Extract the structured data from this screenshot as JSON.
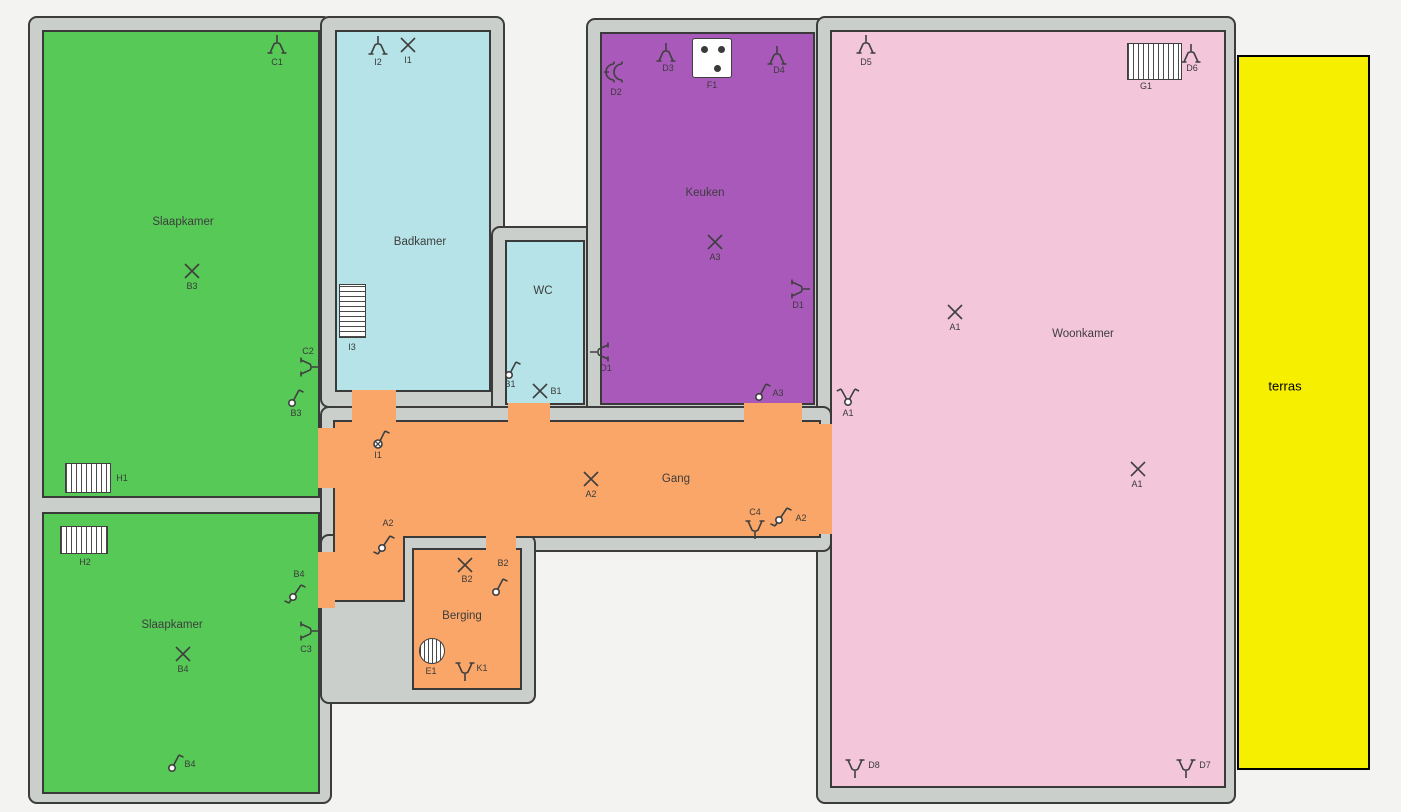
{
  "title": "Plattegrond elektrische installatie",
  "colors": {
    "wall": "#cbcfcb",
    "wall_edge": "#3c3c3c",
    "green": "#57c957",
    "cyan": "#b5e3e7",
    "purple": "#a959ba",
    "pink": "#f4c6da",
    "orange": "#f9a668",
    "yellow": "#f7ef00",
    "stroke": "#3f3f3f",
    "label": "#3d3d3d",
    "terras_border": "#000000"
  },
  "walls": [
    {
      "x": 28,
      "y": 16,
      "w": 304,
      "h": 788
    },
    {
      "x": 320,
      "y": 16,
      "w": 185,
      "h": 392
    },
    {
      "x": 491,
      "y": 226,
      "w": 108,
      "h": 192
    },
    {
      "x": 586,
      "y": 18,
      "w": 243,
      "h": 400
    },
    {
      "x": 816,
      "y": 16,
      "w": 420,
      "h": 788
    },
    {
      "x": 320,
      "y": 406,
      "w": 512,
      "h": 146
    },
    {
      "x": 320,
      "y": 534,
      "w": 216,
      "h": 170
    }
  ],
  "rooms": [
    {
      "id": "slaapkamer-1",
      "label": "Slaapkamer",
      "x": 42,
      "y": 30,
      "w": 278,
      "h": 468,
      "color": "green",
      "lx": 183,
      "ly": 222
    },
    {
      "id": "slaapkamer-2",
      "label": "Slaapkamer",
      "x": 42,
      "y": 512,
      "w": 278,
      "h": 282,
      "color": "green",
      "lx": 172,
      "ly": 625
    },
    {
      "id": "badkamer",
      "label": "Badkamer",
      "x": 335,
      "y": 30,
      "w": 156,
      "h": 362,
      "color": "cyan",
      "lx": 420,
      "ly": 242
    },
    {
      "id": "wc",
      "label": "WC",
      "x": 505,
      "y": 240,
      "w": 80,
      "h": 165,
      "color": "cyan",
      "lx": 543,
      "ly": 291
    },
    {
      "id": "keuken",
      "label": "Keuken",
      "x": 600,
      "y": 32,
      "w": 215,
      "h": 373,
      "color": "purple",
      "lx": 705,
      "ly": 193
    },
    {
      "id": "woonkamer",
      "label": "Woonkamer",
      "x": 830,
      "y": 30,
      "w": 396,
      "h": 758,
      "color": "pink",
      "lx": 1083,
      "ly": 334
    },
    {
      "id": "gang-vertikaal",
      "label": "",
      "x": 333,
      "y": 420,
      "w": 72,
      "h": 182,
      "color": "orange",
      "lx": 0,
      "ly": 0
    },
    {
      "id": "gang",
      "label": "Gang",
      "x": 333,
      "y": 420,
      "w": 488,
      "h": 118,
      "color": "orange",
      "lx": 676,
      "ly": 479
    },
    {
      "id": "berging",
      "label": "Berging",
      "x": 412,
      "y": 548,
      "w": 110,
      "h": 142,
      "color": "orange",
      "lx": 462,
      "ly": 616
    },
    {
      "id": "terras",
      "label": "terras",
      "x": 1237,
      "y": 55,
      "w": 133,
      "h": 715,
      "color": "yellow",
      "lx": 1285,
      "ly": 386,
      "border": "terras_border",
      "labelSize": 13
    }
  ],
  "gaps": [
    {
      "x": 335,
      "y": 422,
      "w": 68,
      "h": 118,
      "color": "orange"
    },
    {
      "x": 818,
      "y": 424,
      "w": 14,
      "h": 110,
      "color": "orange"
    },
    {
      "x": 352,
      "y": 390,
      "w": 44,
      "h": 32,
      "color": "orange"
    },
    {
      "x": 508,
      "y": 403,
      "w": 42,
      "h": 19,
      "color": "orange"
    },
    {
      "x": 744,
      "y": 403,
      "w": 58,
      "h": 19,
      "color": "orange"
    },
    {
      "x": 318,
      "y": 428,
      "w": 17,
      "h": 60,
      "color": "orange"
    },
    {
      "x": 318,
      "y": 552,
      "w": 17,
      "h": 56,
      "color": "orange"
    },
    {
      "x": 486,
      "y": 536,
      "w": 30,
      "h": 14,
      "color": "orange"
    }
  ],
  "symbols": [
    {
      "type": "wall-lamp",
      "x": 277,
      "y": 47,
      "rot": 0,
      "label": "C1",
      "lx": 277,
      "ly": 62
    },
    {
      "type": "ceiling-light",
      "x": 192,
      "y": 271,
      "label": "B3",
      "lx": 192,
      "ly": 286
    },
    {
      "type": "wall-lamp",
      "x": 307,
      "y": 367,
      "rot": 90,
      "label": "C2",
      "lx": 308,
      "ly": 351
    },
    {
      "type": "switch-1",
      "x": 296,
      "y": 398,
      "label": "B3",
      "lx": 296,
      "ly": 413
    },
    {
      "type": "radiator",
      "x": 88,
      "y": 478,
      "w": 46,
      "h": 30,
      "stripes": "v",
      "label": "H1",
      "lx": 122,
      "ly": 478
    },
    {
      "type": "radiator",
      "x": 84,
      "y": 540,
      "w": 48,
      "h": 28,
      "stripes": "v",
      "label": "H2",
      "lx": 85,
      "ly": 562
    },
    {
      "type": "switch-dual",
      "x": 297,
      "y": 595,
      "label": "B4",
      "lx": 299,
      "ly": 574
    },
    {
      "type": "wall-lamp",
      "x": 307,
      "y": 631,
      "rot": 90,
      "label": "C3",
      "lx": 306,
      "ly": 649
    },
    {
      "type": "ceiling-light",
      "x": 183,
      "y": 654,
      "label": "B4",
      "lx": 183,
      "ly": 669
    },
    {
      "type": "switch-1",
      "x": 176,
      "y": 763,
      "label": "B4",
      "lx": 190,
      "ly": 764
    },
    {
      "type": "wall-lamp",
      "x": 378,
      "y": 48,
      "rot": 0,
      "label": "I2",
      "lx": 378,
      "ly": 62
    },
    {
      "type": "ceiling-light",
      "x": 408,
      "y": 45,
      "label": "I1",
      "lx": 408,
      "ly": 60
    },
    {
      "type": "radiator",
      "x": 352,
      "y": 311,
      "w": 27,
      "h": 54,
      "stripes": "h",
      "label": "I3",
      "lx": 352,
      "ly": 347
    },
    {
      "type": "switch-1",
      "x": 513,
      "y": 370,
      "label": "B1",
      "lx": 510,
      "ly": 384
    },
    {
      "type": "ceiling-light",
      "x": 540,
      "y": 391,
      "label": "B1",
      "lx": 556,
      "ly": 391
    },
    {
      "type": "socket-double",
      "x": 616,
      "y": 73,
      "label": "D2",
      "lx": 616,
      "ly": 92
    },
    {
      "type": "wall-lamp",
      "x": 666,
      "y": 55,
      "rot": 0,
      "label": "D3",
      "lx": 668,
      "ly": 68
    },
    {
      "type": "stove",
      "x": 712,
      "y": 58,
      "w": 40,
      "h": 40,
      "label": "F1",
      "lx": 712,
      "ly": 85
    },
    {
      "type": "wall-lamp",
      "x": 777,
      "y": 58,
      "rot": 0,
      "label": "D4",
      "lx": 779,
      "ly": 70
    },
    {
      "type": "wall-lamp",
      "x": 798,
      "y": 289,
      "rot": 90,
      "label": "D1",
      "lx": 798,
      "ly": 305
    },
    {
      "type": "ceiling-light",
      "x": 715,
      "y": 242,
      "label": "A3",
      "lx": 715,
      "ly": 257
    },
    {
      "type": "wall-lamp",
      "x": 602,
      "y": 352,
      "rot": 270,
      "label": "D1",
      "lx": 606,
      "ly": 368
    },
    {
      "type": "switch-1",
      "x": 763,
      "y": 392,
      "label": "A3",
      "lx": 778,
      "ly": 393
    },
    {
      "type": "wall-lamp",
      "x": 866,
      "y": 47,
      "rot": 0,
      "label": "D5",
      "lx": 866,
      "ly": 62
    },
    {
      "type": "radiator",
      "x": 1154,
      "y": 61,
      "w": 55,
      "h": 37,
      "stripes": "v",
      "label": "G1",
      "lx": 1146,
      "ly": 86
    },
    {
      "type": "wall-lamp",
      "x": 1191,
      "y": 56,
      "rot": 0,
      "label": "D6",
      "lx": 1192,
      "ly": 68
    },
    {
      "type": "ceiling-light",
      "x": 955,
      "y": 312,
      "label": "A1",
      "lx": 955,
      "ly": 327
    },
    {
      "type": "switch-serial",
      "x": 848,
      "y": 397,
      "label": "A1",
      "lx": 848,
      "ly": 413
    },
    {
      "type": "ceiling-light",
      "x": 1138,
      "y": 469,
      "label": "A1",
      "lx": 1137,
      "ly": 484
    },
    {
      "type": "wall-lamp",
      "x": 855,
      "y": 766,
      "rot": 180,
      "label": "D8",
      "lx": 874,
      "ly": 765
    },
    {
      "type": "wall-lamp",
      "x": 1186,
      "y": 766,
      "rot": 180,
      "label": "D7",
      "lx": 1205,
      "ly": 765
    },
    {
      "type": "dimmer",
      "x": 382,
      "y": 440,
      "label": "I1",
      "lx": 378,
      "ly": 455
    },
    {
      "type": "ceiling-light",
      "x": 591,
      "y": 479,
      "label": "A2",
      "lx": 591,
      "ly": 494
    },
    {
      "type": "switch-dual",
      "x": 386,
      "y": 546,
      "label": "A2",
      "lx": 388,
      "ly": 523
    },
    {
      "type": "wall-lamp",
      "x": 755,
      "y": 527,
      "rot": 180,
      "label": "C4",
      "lx": 755,
      "ly": 512
    },
    {
      "type": "switch-dual",
      "x": 783,
      "y": 518,
      "label": "A2",
      "lx": 801,
      "ly": 518
    },
    {
      "type": "ceiling-light",
      "x": 465,
      "y": 565,
      "label": "B2",
      "lx": 467,
      "ly": 579
    },
    {
      "type": "switch-1",
      "x": 500,
      "y": 587,
      "label": "B2",
      "lx": 503,
      "ly": 563
    },
    {
      "type": "vent",
      "x": 432,
      "y": 651,
      "w": 26,
      "h": 26,
      "label": "E1",
      "lx": 431,
      "ly": 671
    },
    {
      "type": "wall-lamp",
      "x": 465,
      "y": 669,
      "rot": 180,
      "label": "K1",
      "lx": 482,
      "ly": 668
    }
  ]
}
